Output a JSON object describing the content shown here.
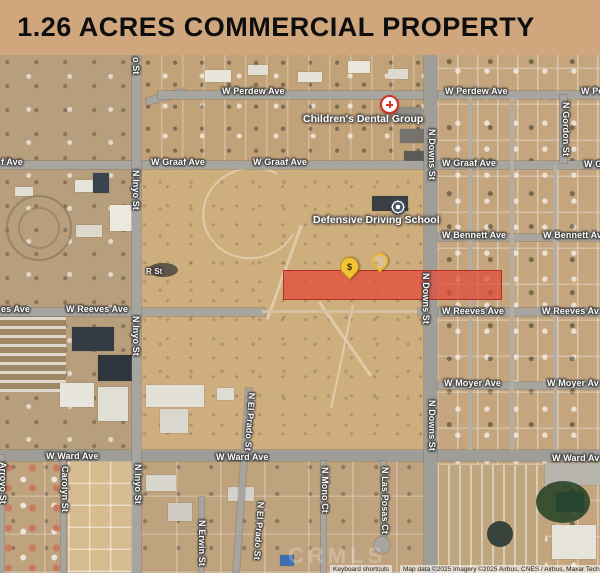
{
  "banner": {
    "title": "1.26 ACRES COMMERCIAL PROPERTY"
  },
  "map": {
    "pois": {
      "dental": {
        "name": "Children's Dental Group"
      },
      "driving_school": {
        "name": "Defensive Driving School"
      }
    },
    "markers": {
      "price_pin": {
        "glyph": "$"
      },
      "secondary_pin": {
        "glyph": ""
      }
    },
    "parcel": {
      "color": "#e0493a"
    },
    "colors": {
      "banner_bg": "#d0a77c",
      "pin_yellow": "#f2c434",
      "parcel_red": "#e0493a"
    },
    "watermark": "CRMLS",
    "attribution": {
      "left": "Keyboard shortcuts",
      "right": "Map data ©2025 Imagery ©2025 Airbus, CNES / Airbus, Maxar Technologies"
    },
    "labels": [
      {
        "text": "W Perdew Ave"
      },
      {
        "text": "W Perdew Ave"
      },
      {
        "text": "W Pe"
      },
      {
        "text": "f Ave"
      },
      {
        "text": "W Graaf Ave"
      },
      {
        "text": "W Graaf Ave"
      },
      {
        "text": "W Graaf Ave"
      },
      {
        "text": "W G"
      },
      {
        "text": "W Bennett Ave"
      },
      {
        "text": "W Bennett Av"
      },
      {
        "text": "es Ave"
      },
      {
        "text": "W Reeves Ave"
      },
      {
        "text": "W Reeves Ave"
      },
      {
        "text": "W Reeves Av"
      },
      {
        "text": "W Moyer Ave"
      },
      {
        "text": "W Moyer Av"
      },
      {
        "text": "W Ward Ave"
      },
      {
        "text": "W Ward Ave"
      },
      {
        "text": "W Ward Av"
      },
      {
        "text": "R St"
      },
      {
        "text": "o St"
      },
      {
        "text": "N Inyo St"
      },
      {
        "text": "N Inyo St"
      },
      {
        "text": "N Inyo St"
      },
      {
        "text": "N Downs St"
      },
      {
        "text": "N Downs St"
      },
      {
        "text": "N Downs St"
      },
      {
        "text": "N Gordon St"
      },
      {
        "text": "N El Prado St"
      },
      {
        "text": "N El Prado St"
      },
      {
        "text": "N Erwin St"
      },
      {
        "text": "Carolyn St"
      },
      {
        "text": "Arroyo St"
      },
      {
        "text": "N Mono Ct"
      },
      {
        "text": "N Las Posas Ct"
      }
    ]
  }
}
